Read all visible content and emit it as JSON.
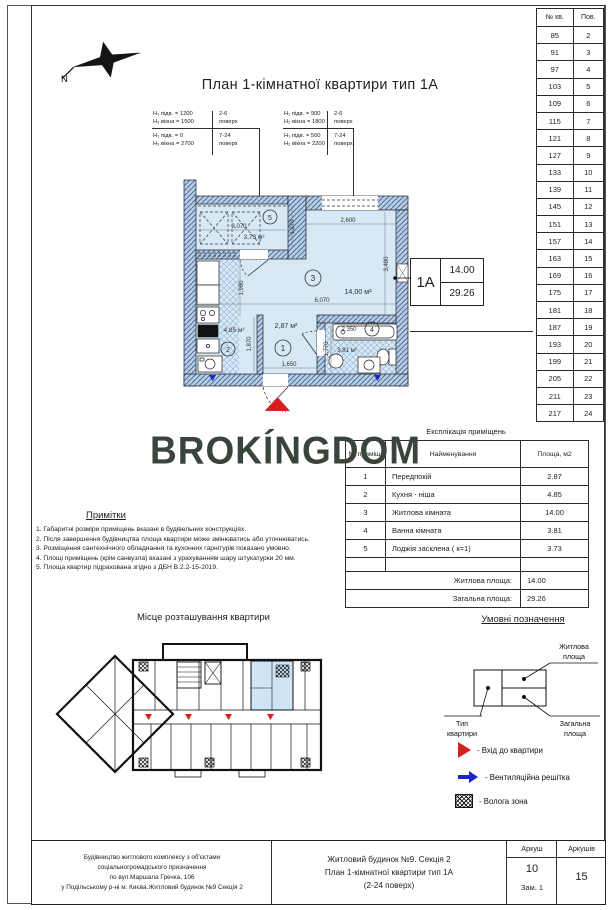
{
  "page": {
    "title": "План 1-кімнатної квартири тип 1А",
    "watermark": "BROKÍNGDOM",
    "compass": "N"
  },
  "height_notes": {
    "left": {
      "row1_a": "H₁ підв.  = 1200",
      "row1_b": "H₂ вікна  = 1500",
      "row1_f": "2-6",
      "row1_s": "поверх",
      "row2_a": "H₁ підв.  =  0",
      "row2_b": "H₂ вікна  = 2700",
      "row2_f": "7-24",
      "row2_s": "поверх"
    },
    "right": {
      "row1_a": "H₁ підв.  = 900",
      "row1_b": "H₂ вікна  = 1800",
      "row1_f": "2-6",
      "row1_s": "поверх",
      "row2_a": "H₁ підв.  = 500",
      "row2_b": "H₂ вікна  = 2200",
      "row2_f": "7-24",
      "row2_s": "поверх"
    }
  },
  "plan": {
    "type_box": {
      "type": "1А",
      "living_area": "14.00",
      "total_area": "29.26"
    },
    "loggia": {
      "num": "5",
      "area": "3,73 м²",
      "dim_w": "3,070",
      "dim_h": "1,270"
    },
    "living": {
      "num": "3",
      "area": "14,00 м²",
      "dim_top": "2,600",
      "dim_right": "3,480",
      "dim_left": "1,980",
      "dim_bottom": "6,070"
    },
    "kitchen": {
      "num": "2",
      "area": "4,85 м²",
      "dim_h": "1,870"
    },
    "hall": {
      "num": "1",
      "area": "2,87 м²",
      "dim_w": "1,650"
    },
    "bathroom": {
      "num": "4",
      "area": "3,81 м²",
      "dim_w": "2 350",
      "dim_h": "1,770"
    }
  },
  "apartments_table": {
    "col1": "№ кв.",
    "col2": "Пов.",
    "rows": [
      [
        "85",
        "2"
      ],
      [
        "91",
        "3"
      ],
      [
        "97",
        "4"
      ],
      [
        "103",
        "5"
      ],
      [
        "109",
        "6"
      ],
      [
        "115",
        "7"
      ],
      [
        "121",
        "8"
      ],
      [
        "127",
        "9"
      ],
      [
        "133",
        "10"
      ],
      [
        "139",
        "11"
      ],
      [
        "145",
        "12"
      ],
      [
        "151",
        "13"
      ],
      [
        "157",
        "14"
      ],
      [
        "163",
        "15"
      ],
      [
        "169",
        "16"
      ],
      [
        "175",
        "17"
      ],
      [
        "181",
        "18"
      ],
      [
        "187",
        "19"
      ],
      [
        "193",
        "20"
      ],
      [
        "199",
        "21"
      ],
      [
        "205",
        "22"
      ],
      [
        "211",
        "23"
      ],
      [
        "217",
        "24"
      ]
    ]
  },
  "explication": {
    "title": "Експлікація приміщень",
    "col_num": "№ приміщ.",
    "col_name": "Найменування",
    "col_area": "Площа, м2",
    "rows": [
      [
        "1",
        "Передпокій",
        "2.87"
      ],
      [
        "2",
        "Кухня - ніша",
        "4.85"
      ],
      [
        "3",
        "Житлова кімната",
        "14.00"
      ],
      [
        "4",
        "Ванна кімната",
        "3.81"
      ],
      [
        "5",
        "Лоджія засклена ( к=1)",
        "3.73"
      ]
    ],
    "living_label": "Житлова площа:",
    "living_value": "14.00",
    "total_label": "Загальна площа:",
    "total_value": "29.26"
  },
  "notes": {
    "title": "Примітки",
    "items": [
      "1. Габаритні розміри приміщень вказані в будівельних конструкціях.",
      "2. Після завершення будівництва площа квартири може змінюватись або уточнюватись.",
      "3. Розміщення сантехнічного обладнання та кухонних гарнітурів показано умовно.",
      "4. Площі приміщень (крім санвузла) вказані з урахуванням шару штукатурки 20 мм.",
      "5. Площа квартир підрахована згідно з ДБН В.2.2-15-2019."
    ]
  },
  "location": {
    "title": "Місце розташування квартири"
  },
  "legend": {
    "title": "Умовні позначення",
    "living_area_label": [
      "Житлова",
      "площа"
    ],
    "type_label": [
      "Тип",
      "квартири"
    ],
    "total_area_label": [
      "Загальна",
      "площа"
    ],
    "entrance": "- Вхід до квартири",
    "vent": "- Вентиляційна решітка",
    "wet": "- Волога зона"
  },
  "title_block": {
    "left_lines": [
      "Будівництво житлового комплексу з об'єктами",
      "соціальногромадського призначення",
      "по вул.Маршала Гречка, 106",
      "у Подільському р-ні м. Києва.Житловий будинок №9 Секція 2"
    ],
    "center_lines": [
      "Житловий будинок №9. Секція 2",
      "План 1-кімнатної квартири тип 1А",
      "(2-24 поверх)"
    ],
    "sheet_label": "Аркуш",
    "sheets_label": "Аркушів",
    "sheet_number": "10",
    "sheet_note": "Зам. 1",
    "sheets_total": "15"
  },
  "colors": {
    "room_fill": "#d7e8f6",
    "wall_fill": "#b6cde3",
    "wall_hatch": "#4f6f9b",
    "accent_red": "#d81f1f",
    "accent_blue": "#1c24cf",
    "logo": "#39443c"
  }
}
